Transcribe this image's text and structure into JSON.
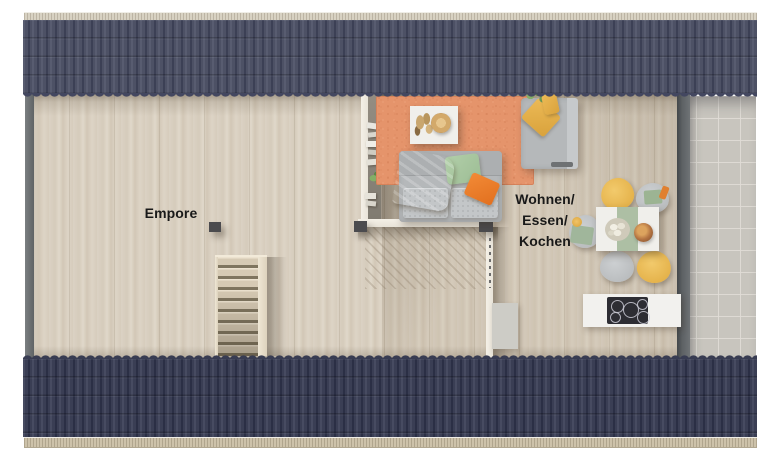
{
  "labels": {
    "empore": "Empore",
    "wohnen_line1": "Wohnen/",
    "wohnen_line2": "Essen/",
    "wohnen_line3": "Kochen"
  },
  "rooms": [
    {
      "id": "empore",
      "label": "Empore"
    },
    {
      "id": "wohnen-essen-kochen",
      "label": "Wohnen/Essen/Kochen"
    }
  ],
  "objects": [
    "roof-band-top",
    "roof-band-bottom",
    "rain-gutter-top",
    "rain-gutter-bottom",
    "wood-floor",
    "staircase",
    "stair-railing",
    "interior-wall-vertical",
    "interior-wall-horizontal",
    "interior-wall-lower",
    "wall-shelf-books",
    "shelf-plant",
    "area-rug",
    "coffee-table",
    "pampas-decor",
    "woven-tray",
    "sofa",
    "throw-blanket",
    "pillow-green",
    "pillow-orange",
    "daybed",
    "pillow-yellow",
    "corner-plant",
    "dining-table",
    "table-runner",
    "flower-bouquet",
    "food-bowl",
    "dining-chairs",
    "kitchen-counter",
    "cooktop",
    "tall-cabinet",
    "terrace-tiles",
    "exterior-wall"
  ],
  "colors": {
    "roof_top": "#4d5165",
    "roof_bottom": "#3a3e54",
    "gutter": "#d8d2c3",
    "floor_wood": "#d9cfc0",
    "rug_orange": "#e5946b",
    "sofa_gray": "#b5b8ba",
    "throw_mustard": "#cb9a4e",
    "pillow_green": "#a9c7a1",
    "pillow_orange": "#ee7e2d",
    "chair_yellow": "#e8bb56",
    "runner_sage": "#adbfa4",
    "wall_dark_gray": "#5d6164",
    "terrace_tile": "#c8c5be",
    "label_text": "#191919"
  }
}
